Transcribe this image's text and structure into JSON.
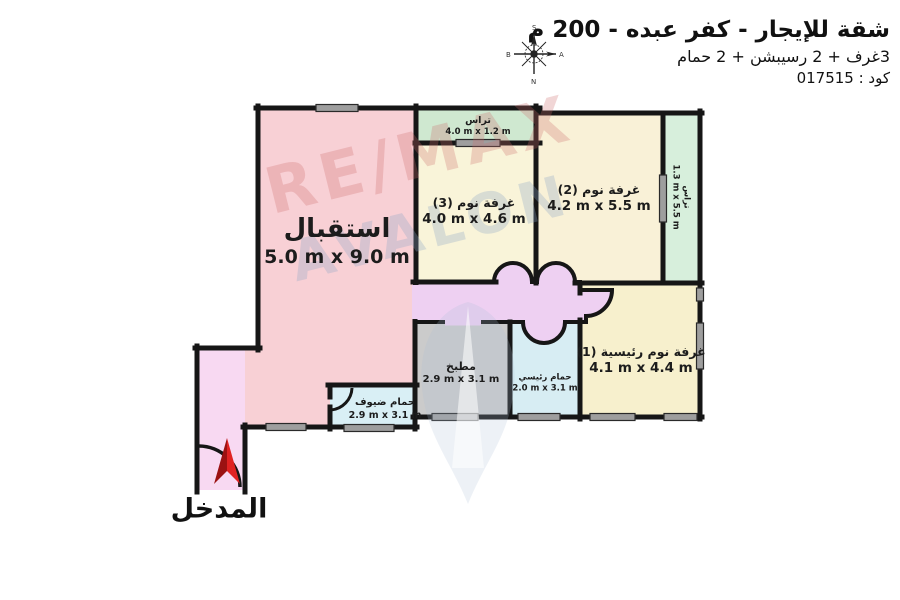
{
  "header": {
    "title": "شقة للإيجار - كفر عبده - 200 م",
    "subtitle": "3غرف + 2 رسيبشن + 2 حمام",
    "code": "كود : 017515",
    "compass": {
      "top": "S",
      "bottom": "N",
      "left": "B",
      "right": "A"
    }
  },
  "colors": {
    "wall": "#161616",
    "window_fill": "#9e9e9e",
    "door_arc": "#161616",
    "arrow_dark": "#9b1212",
    "arrow_bright": "#e02222"
  },
  "rooms": {
    "reception": {
      "name": "استقبال",
      "size": "5.0 m x 9.0 m",
      "color": "#f8d0d5"
    },
    "entrance_corridor": {
      "color": "#f8d9f2"
    },
    "hall": {
      "color": "#eed0f2"
    },
    "terrace_top": {
      "name": "تراس",
      "size": "4.0 m x 1.2 m",
      "color": "#cfe8d0"
    },
    "bedroom3": {
      "name": "غرفة نوم (3)",
      "size": "4.0 m x 4.6 m",
      "color": "#f9f4d9"
    },
    "bedroom2": {
      "name": "غرفة نوم (2)",
      "size": "4.2 m x 5.5 m",
      "color": "#f9f1d7"
    },
    "terrace_right": {
      "name": "تراس",
      "size": "1.3 m x 5.5 m",
      "color": "#d7efdc"
    },
    "master_bedroom": {
      "name": "غرفة نوم رئيسية (1)",
      "size": "4.1 m x 4.4 m",
      "color": "#f7f0cd"
    },
    "kitchen": {
      "name": "مطبخ",
      "size": "2.9 m x 3.1 m",
      "color": "#cbcbcb"
    },
    "master_bath": {
      "name": "حمام رئيسي",
      "size": "2.0 m x 3.1 m",
      "color": "#d7edf3"
    },
    "guest_bath": {
      "name": "حمام ضيوف",
      "size": "2.9 m x 3.1 m",
      "color": "#d9eff5"
    }
  },
  "entrance": {
    "label": "المدخل"
  },
  "watermark": {
    "line1": "RE/MAX",
    "line2": "AVALON"
  }
}
